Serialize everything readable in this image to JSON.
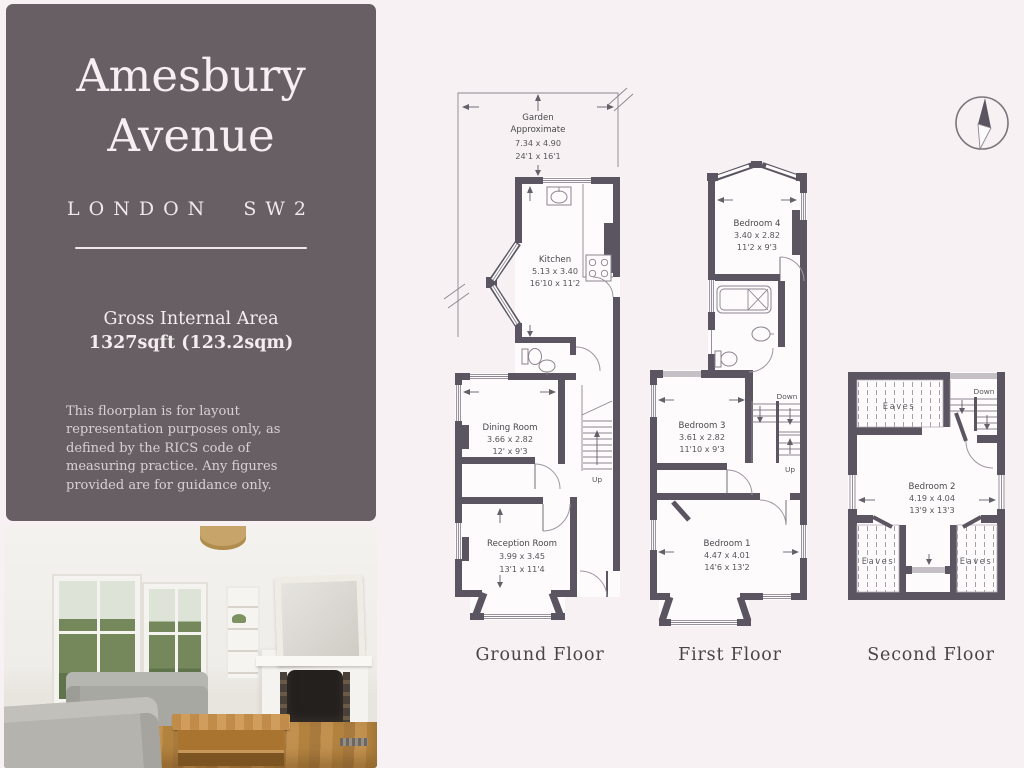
{
  "panel": {
    "title_line1": "Amesbury",
    "title_line2": "Avenue",
    "location": "LONDON  SW2",
    "area_label": "Gross Internal Area",
    "area_value": "1327sqft (123.2sqm)",
    "disclaimer": "This floorplan is for layout representation purposes only, as defined by the RICS code of measuring practice. Any figures provided are for guidance only."
  },
  "floors": {
    "ground": {
      "label": "Ground Floor",
      "rooms": {
        "garden": {
          "name": "Garden",
          "qualifier": "Approximate",
          "metric": "7.34 x 4.90",
          "imperial": "24'1 x 16'1"
        },
        "kitchen": {
          "name": "Kitchen",
          "metric": "5.13 x 3.40",
          "imperial": "16'10 x 11'2"
        },
        "dining_room": {
          "name": "Dining Room",
          "metric": "3.66 x 2.82",
          "imperial": "12' x 9'3"
        },
        "reception_room": {
          "name": "Reception Room",
          "metric": "3.99 x 3.45",
          "imperial": "13'1 x 11'4"
        }
      },
      "stairs": {
        "up": "Up"
      }
    },
    "first": {
      "label": "First Floor",
      "rooms": {
        "bedroom4": {
          "name": "Bedroom 4",
          "metric": "3.40 x 2.82",
          "imperial": "11'2 x 9'3"
        },
        "bedroom3": {
          "name": "Bedroom 3",
          "metric": "3.61 x 2.82",
          "imperial": "11'10 x 9'3"
        },
        "bedroom1": {
          "name": "Bedroom 1",
          "metric": "4.47 x 4.01",
          "imperial": "14'6 x 13'2"
        }
      },
      "stairs": {
        "down": "Down",
        "up": "Up"
      }
    },
    "second": {
      "label": "Second Floor",
      "rooms": {
        "bedroom2": {
          "name": "Bedroom 2",
          "metric": "4.19 x 4.04",
          "imperial": "13'9 x 13'3"
        },
        "eaves_top": {
          "name": "Eaves"
        },
        "eaves_left": {
          "name": "Eaves"
        },
        "eaves_right": {
          "name": "Eaves"
        }
      },
      "stairs": {
        "down": "Down"
      }
    }
  },
  "colors": {
    "wall": "#5a5560",
    "panel_bg": "#675f63",
    "page_bg": "#f8f1f3"
  }
}
